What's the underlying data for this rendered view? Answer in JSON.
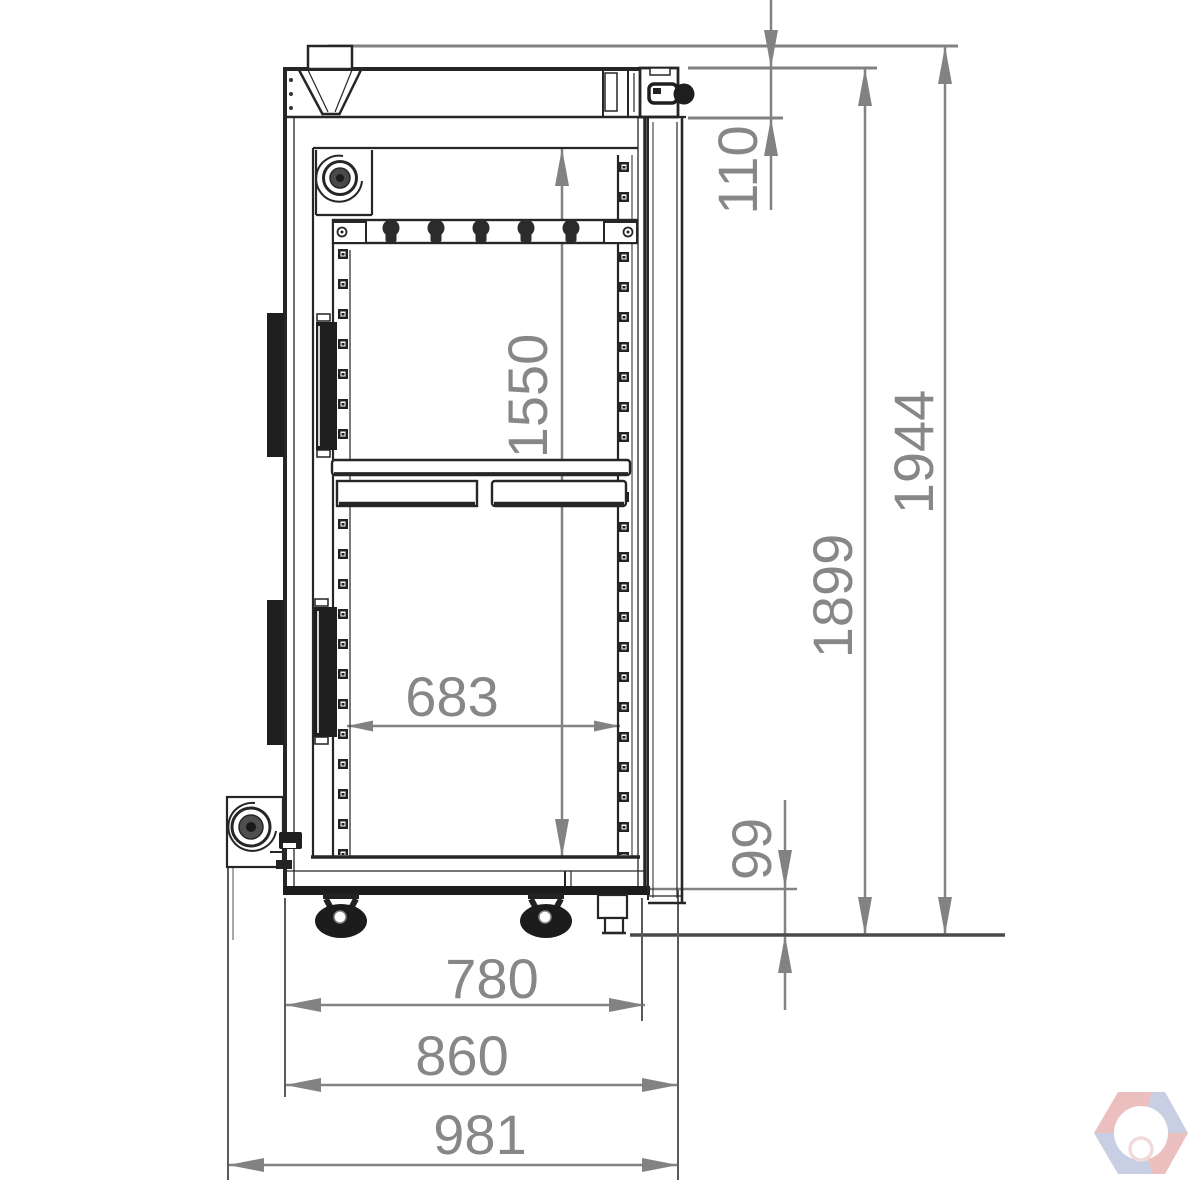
{
  "drawing": {
    "type": "technical-drawing",
    "background": "#ffffff",
    "line_color": "#262626",
    "dimension_color": "#828282",
    "dims": {
      "v110": "110",
      "v1550": "1550",
      "v1899": "1899",
      "v1944": "1944",
      "v99": "99",
      "h683": "683",
      "h780": "780",
      "h860": "860",
      "h981": "981"
    }
  },
  "watermark": {
    "icon": "hexagon-shutter-logo",
    "red": "#db8080",
    "blue": "#94a0c6"
  }
}
